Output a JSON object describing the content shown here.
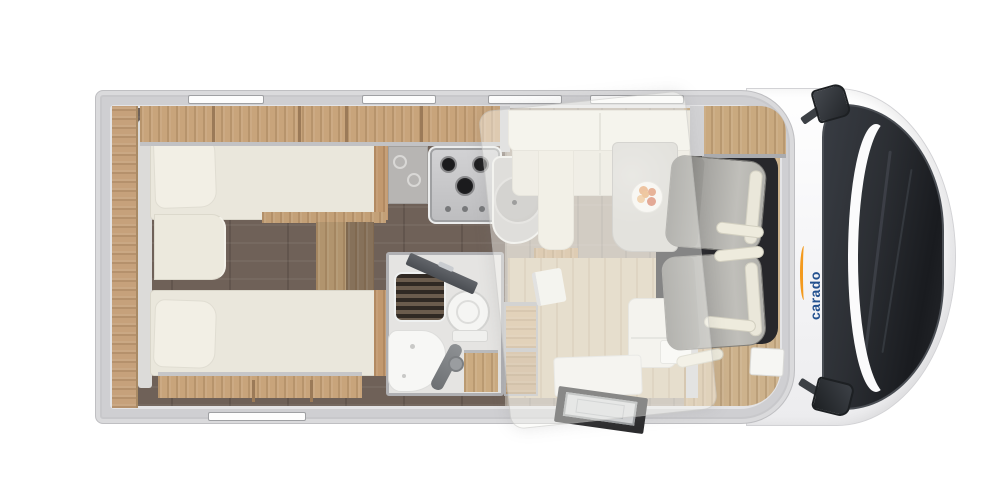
{
  "scene": {
    "type": "motorhome-floorplan-top-view",
    "background": "#ffffff"
  },
  "branding": {
    "logo_text": "carado",
    "logo_color": "#23518f",
    "swoosh_color": "#f39a1e"
  },
  "palette": {
    "wall_gray": "#cfcfd2",
    "wood_cabinet": "#c8a47b",
    "wood_floor_light": "#d8c9ad",
    "floor_dark": "#6f6158",
    "floor_dinette": "#b3a89c",
    "mattress_cream": "#eae7dc",
    "cab_seat_gray": "#a9a8a4",
    "windshield_dark": "#2c2f34",
    "cab_mat_black": "#27272b"
  },
  "rooms": {
    "rear_bedroom": {
      "features": [
        "single-bed-top",
        "single-bed-bottom",
        "center-cushion",
        "overhead-cabinets",
        "rear-shelf",
        "floor-steps"
      ]
    },
    "kitchen": {
      "features": [
        "three-burner-hob",
        "round-sink",
        "overhead-cabinets",
        "glass-rack"
      ],
      "burner_count": 3
    },
    "bathroom": {
      "features": [
        "shower-grate",
        "toilet",
        "washbasin",
        "vanity-cabinet",
        "open-door"
      ]
    },
    "dinette": {
      "features": [
        "l-shaped-bench",
        "table-with-plate",
        "front-seat",
        "side-box"
      ]
    },
    "entrance": {
      "features": [
        "entry-step-mat",
        "open-entry-door",
        "wardrobe-steps"
      ]
    },
    "cab": {
      "features": [
        "swivel-seat-passenger",
        "swivel-seat-driver",
        "side-mirror-top",
        "side-mirror-bottom",
        "windshield"
      ]
    }
  },
  "overlay": {
    "drop_down_bed": true
  }
}
